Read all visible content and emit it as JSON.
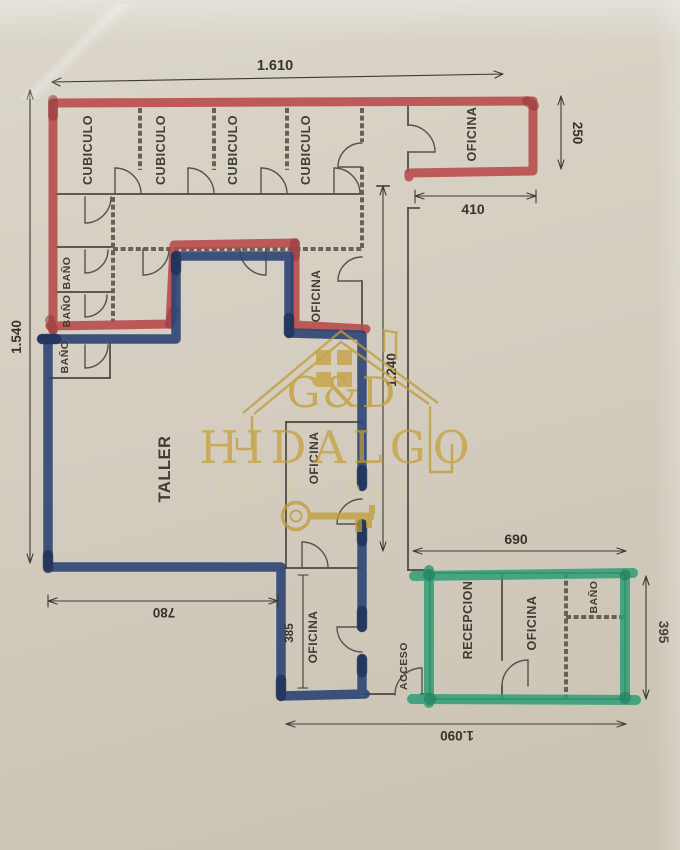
{
  "watermark": {
    "initials": "G&D",
    "name": "HIDALGO",
    "tagline": "PROPIEDADES"
  },
  "rooms": {
    "cubiculo_1": "CUBICULO",
    "cubiculo_2": "CUBICULO",
    "cubiculo_3": "CUBICULO",
    "cubiculo_4": "CUBICULO",
    "oficina_top_right": "OFICINA",
    "bano_1": "BAÑO",
    "bano_2": "BAÑO",
    "bano_3": "BAÑO",
    "oficina_center": "OFICINA",
    "oficina_middle": "OFICINA",
    "oficina_bottom": "OFICINA",
    "taller": "TALLER",
    "acceso": "ACCESO",
    "recepcion": "RECEPCION",
    "oficina_reception": "OFICINA",
    "bano_reception": "BAÑO"
  },
  "dimensions": {
    "top_total": "1.610",
    "left_total": "1.540",
    "right_office_depth": "250",
    "right_office_width": "410",
    "corridor": "1.240",
    "taller_width": "780",
    "bottom_office": "385",
    "reception_width": "690",
    "reception_depth": "395",
    "bottom_total": "1.090"
  },
  "colors": {
    "red_marker": "#b8494a",
    "red_marker_dark": "#93383a",
    "blue_marker": "#2c4576",
    "blue_marker_dark": "#1b2d52",
    "green_marker": "#2f9e78",
    "green_marker_dark": "#1e7c5c",
    "gold": "#c39e37",
    "gold_light": "#d8cba4",
    "wall": "#4a483f",
    "dim_text": "#3b3a33",
    "paper": "#d3ccbf"
  }
}
